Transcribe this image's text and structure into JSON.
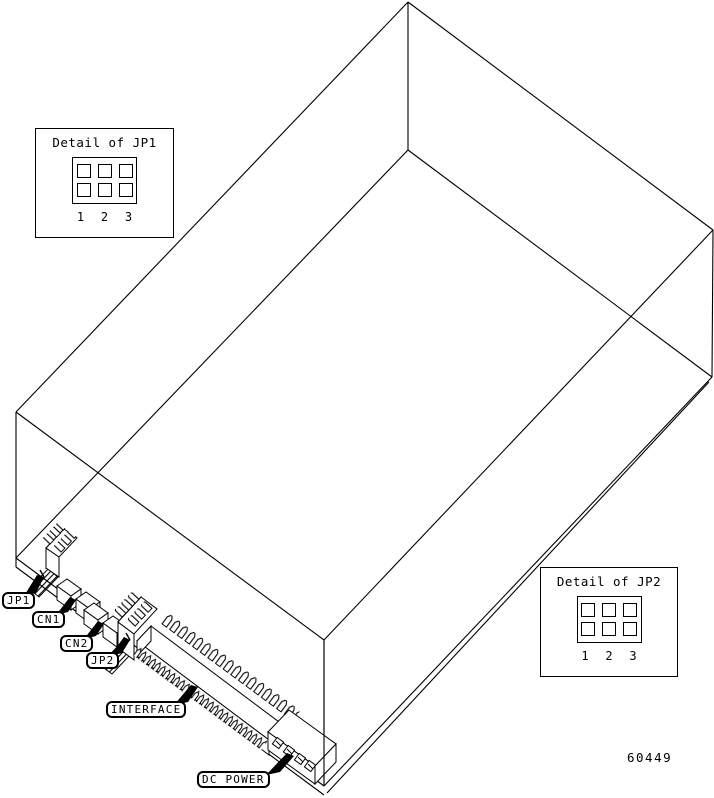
{
  "diagram": {
    "figure_number": "60449",
    "detail_boxes": [
      {
        "title": "Detail of JP1",
        "pins": [
          "1",
          "2",
          "3"
        ]
      },
      {
        "title": "Detail of JP2",
        "pins": [
          "1",
          "2",
          "3"
        ]
      }
    ],
    "callouts": [
      {
        "label": "JP1"
      },
      {
        "label": "CN1"
      },
      {
        "label": "CN2"
      },
      {
        "label": "JP2"
      },
      {
        "label": "INTERFACE"
      },
      {
        "label": "DC POWER"
      }
    ],
    "colors": {
      "line": "#000000",
      "background": "#ffffff"
    }
  }
}
